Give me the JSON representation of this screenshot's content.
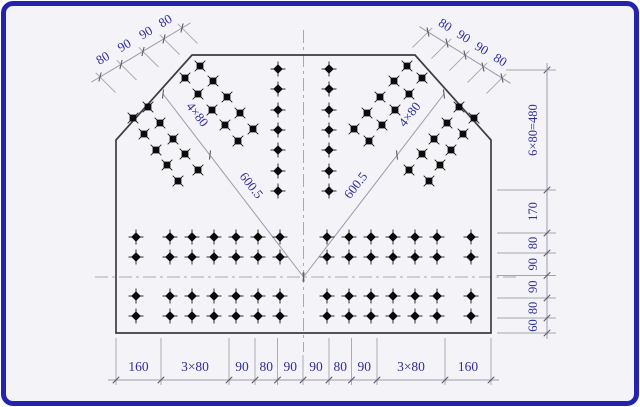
{
  "figure": {
    "kind": "engineering-drawing",
    "subject": "gusset-plate-bolt-layout",
    "frame_color": "#2323ad",
    "bg_color": "#f4f3f7",
    "plate_line_color": "#3c3c44",
    "dim_line_color": "#9b9bad",
    "dim_text_color": "#2f2f99",
    "bolt_color": "#0c0c0c"
  },
  "plate_outline": [
    [
      192,
      55
    ],
    [
      415,
      55
    ],
    [
      491,
      140
    ],
    [
      491,
      333
    ],
    [
      116,
      333
    ],
    [
      116,
      140
    ]
  ],
  "centerlines": {
    "vertical": {
      "x": 303.5,
      "y1": 30,
      "y2": 352
    },
    "horizontal": {
      "y": 277,
      "x1": 95,
      "x2": 516
    }
  },
  "bolts": {
    "diagonal_left": [
      [
        200,
        66
      ],
      [
        213,
        81
      ],
      [
        227,
        97
      ],
      [
        240,
        113
      ],
      [
        253,
        129
      ],
      [
        185,
        78
      ],
      [
        198,
        94
      ],
      [
        212,
        110
      ],
      [
        225,
        125
      ],
      [
        238,
        141
      ],
      [
        148,
        107
      ],
      [
        160,
        123
      ],
      [
        173,
        139
      ],
      [
        185,
        154
      ],
      [
        198,
        170
      ],
      [
        133,
        118
      ],
      [
        144,
        134
      ],
      [
        156,
        150
      ],
      [
        167,
        165
      ],
      [
        178,
        181
      ]
    ],
    "diagonal_right": [
      [
        407,
        66
      ],
      [
        394,
        81
      ],
      [
        380,
        97
      ],
      [
        367,
        113
      ],
      [
        354,
        129
      ],
      [
        422,
        78
      ],
      [
        409,
        94
      ],
      [
        395,
        110
      ],
      [
        382,
        125
      ],
      [
        369,
        141
      ],
      [
        459,
        107
      ],
      [
        447,
        123
      ],
      [
        434,
        139
      ],
      [
        422,
        154
      ],
      [
        409,
        170
      ],
      [
        474,
        118
      ],
      [
        463,
        134
      ],
      [
        451,
        150
      ],
      [
        440,
        165
      ],
      [
        429,
        181
      ]
    ],
    "center_columns": {
      "xs": [
        278,
        329
      ],
      "ys": [
        69,
        89,
        110,
        130,
        150,
        171,
        191
      ]
    },
    "bottom_grid": {
      "cols": [
        136,
        170,
        192,
        214,
        236,
        258,
        280,
        327,
        349,
        371,
        393,
        415,
        437,
        471
      ],
      "rows": [
        237,
        257,
        296,
        316
      ]
    }
  },
  "dimensions": {
    "top_left_chain": {
      "labels": [
        "80",
        "90",
        "90",
        "80"
      ],
      "ticks": [
        [
          100,
          77
        ],
        [
          121,
          64.5
        ],
        [
          143,
          51.5
        ],
        [
          164,
          39
        ],
        [
          182,
          28
        ]
      ],
      "label_angle": -31,
      "label_offset": [
        -5.5,
        -9
      ],
      "slash_angle": -76,
      "ext_dir": [
        0.707,
        0.707
      ]
    },
    "top_right_chain": {
      "labels": [
        "80",
        "90",
        "90",
        "80"
      ],
      "ticks": [
        [
          428,
          32
        ],
        [
          447,
          43
        ],
        [
          465,
          55
        ],
        [
          483,
          67
        ],
        [
          502,
          78
        ]
      ],
      "label_angle": 32,
      "label_offset": [
        5.5,
        -9
      ],
      "slash_angle": 77,
      "ext_dir": [
        -0.707,
        0.707
      ]
    },
    "right_chain": {
      "x": 547,
      "line_y1": 63,
      "line_y2": 339,
      "ticks_y": [
        70,
        190,
        233,
        253,
        275.5,
        298,
        318,
        333
      ],
      "labels": [
        "6×80=480",
        "170",
        "80",
        "90",
        "90",
        "80",
        "60"
      ],
      "slash_angle": 135,
      "ext_x_default": 497,
      "ext_x_first": 514,
      "ext_x_end": 556
    },
    "bottom_chain": {
      "y": 380,
      "line_x1": 108,
      "line_x2": 499,
      "ticks_x": [
        116,
        161,
        229,
        255,
        277.5,
        303,
        329,
        351.5,
        377,
        445,
        491
      ],
      "labels": [
        "160",
        "3×80",
        "90",
        "80",
        "90",
        "90",
        "80",
        "90",
        "3×80",
        "160"
      ],
      "slash_angle": -45,
      "ext_y1": 338,
      "ext_y2": 385,
      "ext_y1_center": 355
    },
    "diagonal_left_dim": {
      "line": [
        [
          163,
          94
        ],
        [
          303.5,
          277
        ]
      ],
      "ticks": [
        [
          163,
          94
        ],
        [
          210,
          155
        ],
        [
          303.5,
          277
        ]
      ],
      "slash_angle": 97,
      "labels": [
        {
          "text": "4×80",
          "x": 194,
          "y": 117,
          "angle": 52
        },
        {
          "text": "600.5",
          "x": 248,
          "y": 188,
          "angle": 52
        }
      ]
    },
    "diagonal_right_dim": {
      "line": [
        [
          444,
          94
        ],
        [
          303.5,
          277
        ]
      ],
      "ticks": [
        [
          444,
          94
        ],
        [
          397,
          155
        ],
        [
          303.5,
          277
        ]
      ],
      "slash_angle": 83,
      "labels": [
        {
          "text": "4×80",
          "x": 413,
          "y": 117,
          "angle": -52
        },
        {
          "text": "600.5",
          "x": 359,
          "y": 188,
          "angle": -52
        }
      ]
    },
    "connector": [
      [
        506,
        70
      ],
      [
        551,
        70
      ]
    ]
  }
}
